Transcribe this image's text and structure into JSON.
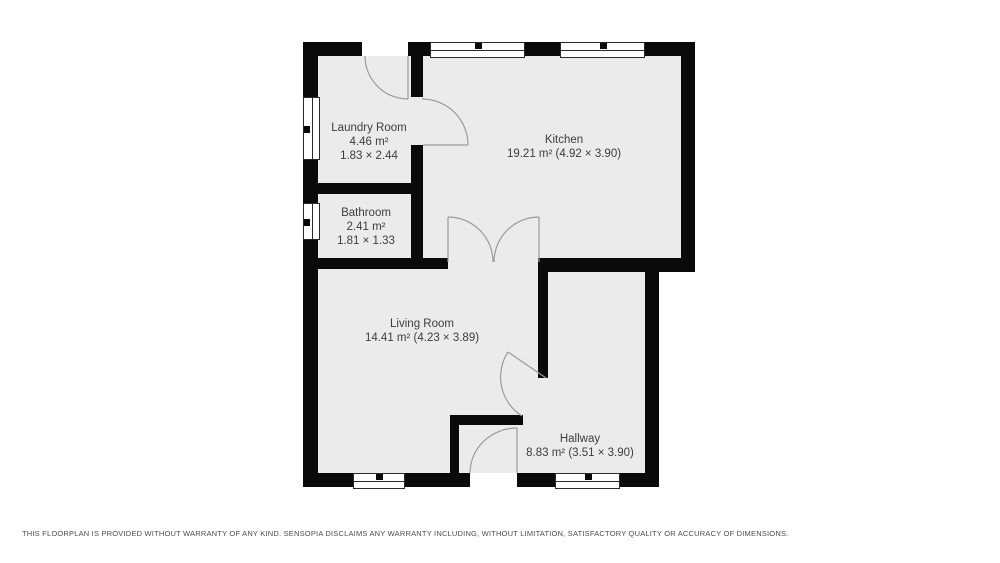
{
  "rooms": [
    {
      "id": "laundry-room",
      "lines": [
        "Laundry Room",
        "4.46 m²",
        "1.83 × 2.44"
      ]
    },
    {
      "id": "kitchen",
      "lines": [
        "Kitchen",
        "19.21 m² (4.92 × 3.90)"
      ]
    },
    {
      "id": "bathroom",
      "lines": [
        "Bathroom",
        "2.41 m²",
        "1.81 × 1.33"
      ]
    },
    {
      "id": "living-room",
      "lines": [
        "Living Room",
        "14.41 m² (4.23 × 3.89)"
      ]
    },
    {
      "id": "hallway",
      "lines": [
        "Hallway",
        "8.83 m² (3.51 × 3.90)"
      ]
    }
  ],
  "disclaimer": "THIS FLOORPLAN IS PROVIDED WITHOUT WARRANTY OF ANY KIND. SENSOPIA DISCLAIMS ANY WARRANTY INCLUDING, WITHOUT LIMITATION, SATISFACTORY QUALITY OR ACCURACY OF DIMENSIONS.",
  "colors": {
    "wall": "#0a0a0a",
    "floor": "#ebebeb",
    "door_stroke": "#9b9b9b",
    "label_text": "#3d3d3d",
    "disclaimer_text": "#4c4c4c",
    "background": "#ffffff"
  }
}
